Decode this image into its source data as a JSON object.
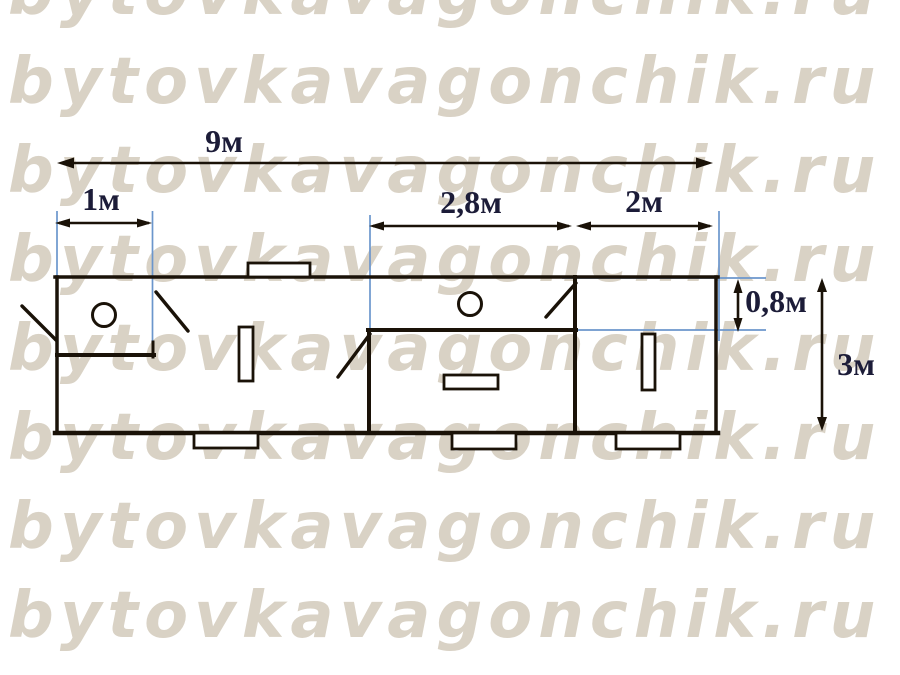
{
  "watermark": {
    "text": "bytovkavagonchik.ru",
    "rows": 8,
    "color": "#d9d2c5"
  },
  "plan": {
    "labels": {
      "total_length": "9м",
      "left_section": "1м",
      "middle_section": "2,8м",
      "right_section": "2м",
      "vestibule_depth": "0,8м",
      "total_depth": "3м"
    },
    "colors": {
      "wall_line": "#1a1208",
      "extension_line": "#6b96cc",
      "label_text": "#1c1c38"
    }
  }
}
